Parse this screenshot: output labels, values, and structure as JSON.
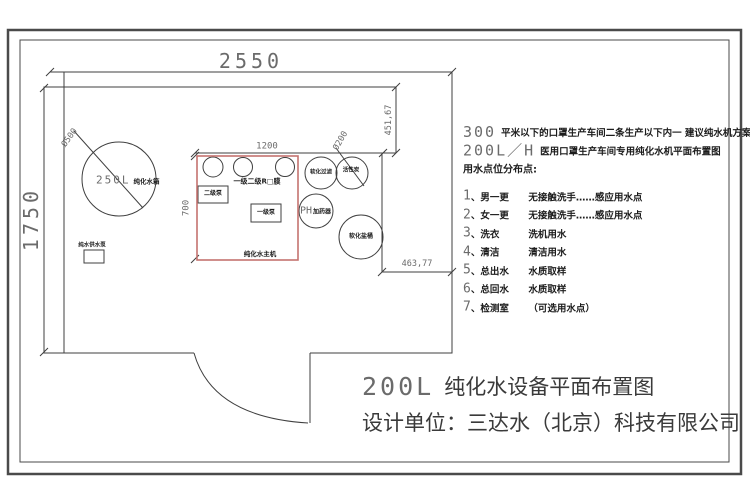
{
  "dims": {
    "room_width": "2550",
    "room_height": "1750",
    "unit_width": "1200",
    "unit_height": "700",
    "niche_height": "451,67",
    "niche_width": "463,77",
    "tank_diameter": "Ø500",
    "carbon_diameter": "Ø200"
  },
  "equipment": {
    "tank_big": "250L",
    "tank_small": "纯化水箱",
    "supply_pump": "纯水供水泵",
    "ro_membrane": "一级二级R□膜",
    "pump_stage2": "二级泵",
    "pump_stage1": "一级泵",
    "main_unit": "纯化水主机",
    "softener_filter": "软化过滤",
    "activated_carbon": "活性炭",
    "ph_big": "PH",
    "ph_small": "加药器",
    "salt_barrel": "软化盐桶"
  },
  "notes": {
    "line1_big": "300",
    "line1_rest": "平米以下的口罩生产车间二条生产以下内一 建议纯水机方案",
    "line2_big": "200L／H",
    "line2_rest": "医用口罩生产车间专用纯化水机平面布置图",
    "heading": "用水点位分布点:",
    "sep": "、",
    "items": [
      {
        "num": "1",
        "label": "男一更",
        "desc": "无接触洗手……感应用水点"
      },
      {
        "num": "2",
        "label": "女一更",
        "desc": "无接触洗手……感应用水点"
      },
      {
        "num": "3",
        "label": "洗衣",
        "desc": "洗机用水"
      },
      {
        "num": "4",
        "label": "清洁",
        "desc": "清洁用水"
      },
      {
        "num": "5",
        "label": "总出水",
        "desc": "水质取样"
      },
      {
        "num": "6",
        "label": "总回水",
        "desc": "水质取样"
      },
      {
        "num": "7",
        "label": "检测室",
        "desc": "（可选用水点）"
      }
    ]
  },
  "title": {
    "big": "200L",
    "rest": "纯化水设备平面布置图",
    "designer": "设计单位：三达水（北京）科技有限公司"
  },
  "colors": {
    "line": "#3f3f3f",
    "red_box": "#c4736f",
    "dim_text": "#6b6b6b"
  }
}
